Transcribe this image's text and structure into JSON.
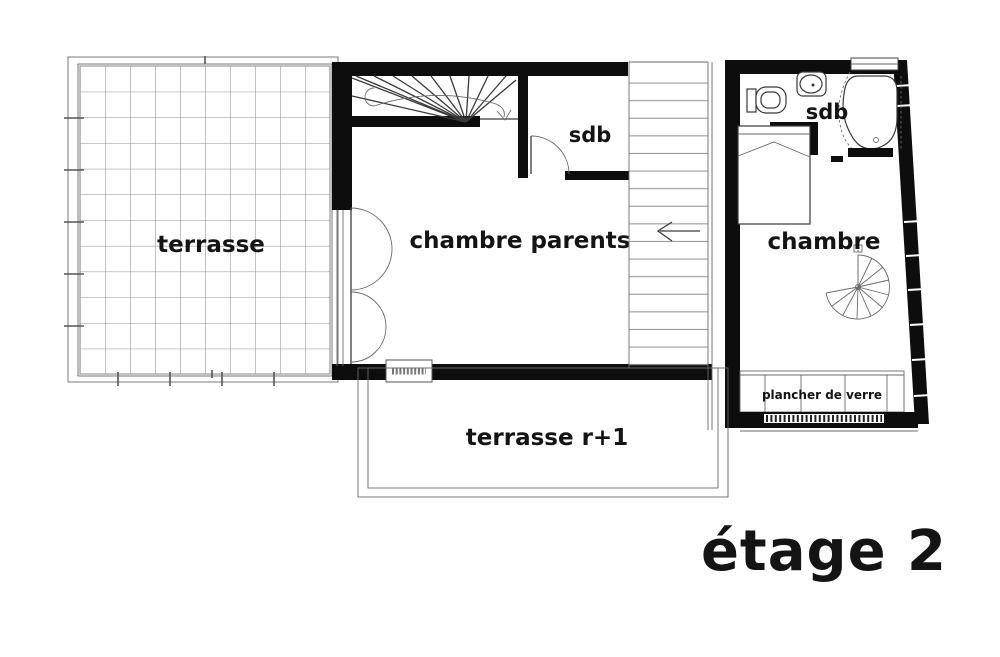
{
  "page": {
    "title": "étage 2"
  },
  "rooms": {
    "terrasse": "terrasse",
    "chambre_parents": "chambre parents",
    "sdb_center": "sdb",
    "sdb_right": "sdb",
    "chambre": "chambre",
    "terrasse_r1": "terrasse r+1",
    "plancher_de_verre": "plancher de verre"
  },
  "colors": {
    "wall": "#0d0d0d",
    "line": "#3a3a3a",
    "grid": "#8f8f8f",
    "background": "#ffffff"
  }
}
